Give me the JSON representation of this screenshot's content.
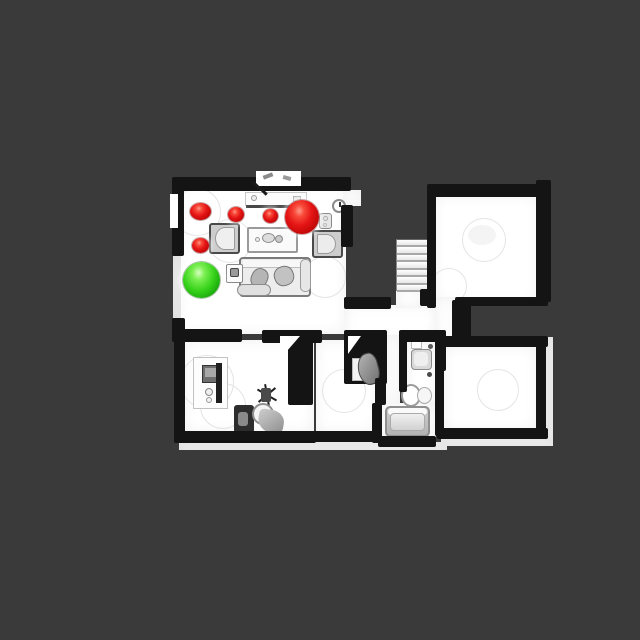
{
  "scene": {
    "type": "top-down-floorplan-render",
    "colors": {
      "background": "#3a3a3a",
      "wall": "#141414",
      "floor": "#ffffff",
      "marker_red": "#e51515",
      "marker_green": "#35d119"
    }
  },
  "markers": {
    "red_spheres": [
      {
        "x": 200,
        "y": 211,
        "w": 21,
        "h": 17
      },
      {
        "x": 236,
        "y": 214,
        "w": 16,
        "h": 15
      },
      {
        "x": 270,
        "y": 216,
        "w": 15,
        "h": 14
      },
      {
        "x": 200,
        "y": 245,
        "w": 17,
        "h": 15
      },
      {
        "x": 302,
        "y": 217,
        "w": 34,
        "h": 34
      }
    ],
    "green_spheres": [
      {
        "x": 201,
        "y": 280,
        "w": 37,
        "h": 36
      }
    ]
  },
  "stairs": {
    "steps": 7
  },
  "rooms": [
    "living-room",
    "top-right-room",
    "hallway",
    "office-room",
    "middle-bedroom",
    "bathroom",
    "bottom-right-room"
  ],
  "furniture": [
    "console-table",
    "wall-clock",
    "speaker",
    "armchair-left",
    "armchair-right",
    "coffee-table",
    "sofa",
    "side-table",
    "desk",
    "monitor",
    "desk-chair",
    "stool",
    "plant",
    "wardrobe",
    "sink",
    "toilet",
    "bathtub",
    "staircase"
  ]
}
